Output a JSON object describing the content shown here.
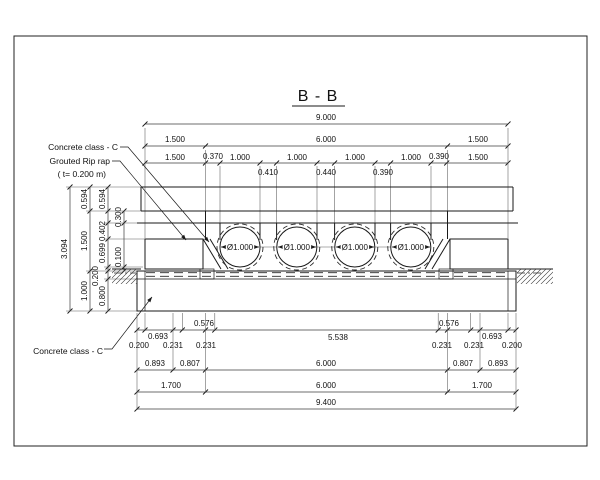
{
  "title": "B - B",
  "annotations": {
    "concrete_top": "Concrete class - C",
    "riprap_line1": "Grouted Rip rap",
    "riprap_line2": "( t= 0.200 m)",
    "concrete_bottom": "Concrete class - C"
  },
  "pipe_labels": [
    "Ø1.000",
    "Ø1.000",
    "Ø1.000",
    "Ø1.000"
  ],
  "dims": {
    "top": {
      "total": "9.000",
      "row2": [
        "1.500",
        "6.000",
        "1.500"
      ],
      "row3": [
        "1.500",
        "0.370",
        "1.000",
        "1.000",
        "1.000",
        "1.000",
        "0.390",
        "1.500"
      ],
      "gaps": [
        "0.410",
        "0.440",
        "0.390"
      ]
    },
    "left": {
      "total": "3.094",
      "chain_a": [
        "0.594",
        "1.500",
        "1.000"
      ],
      "chain_b": [
        "0.594",
        "0.402",
        "0.699",
        "0.200",
        "0.800"
      ],
      "chain_c": [
        "0.300",
        "0.100"
      ]
    },
    "bottom": {
      "row1": [
        "0.576",
        "5.538",
        "0.576"
      ],
      "row2_left": [
        "0.200",
        "0.693",
        "0.231",
        "0.231"
      ],
      "row2_right": [
        "0.231",
        "0.231",
        "0.693",
        "0.200"
      ],
      "row3": [
        "0.893",
        "0.807",
        "6.000",
        "0.807",
        "0.893"
      ],
      "row4": [
        "1.700",
        "6.000",
        "1.700"
      ],
      "total": "9.400"
    }
  },
  "colors": {
    "line": "#1a1a1a",
    "dim": "#3c3c3c",
    "background": "#ffffff"
  }
}
